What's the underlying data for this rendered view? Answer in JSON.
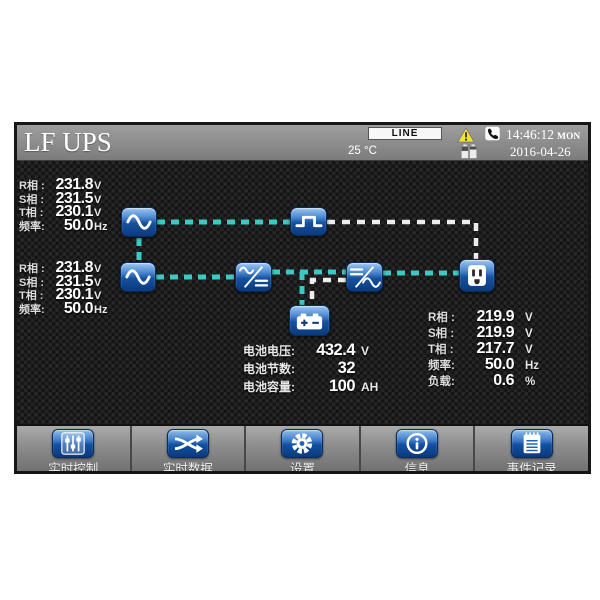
{
  "header": {
    "title": "LF UPS",
    "status": {
      "line": "LINE",
      "temperature": "25 °C",
      "time": "14:46:12",
      "weekday": "MON",
      "date": "2016-04-26",
      "icons": [
        "warning-icon",
        "battery-cells-icon",
        "phone-icon"
      ]
    }
  },
  "bypass_input": {
    "rows": [
      {
        "label": "R相 :",
        "value": "231.8",
        "unit": "V"
      },
      {
        "label": "S相 :",
        "value": "231.5",
        "unit": "V"
      },
      {
        "label": "T相 :",
        "value": "230.1",
        "unit": "V"
      },
      {
        "label": "频率:",
        "value": "50.0",
        "unit": "Hz"
      }
    ]
  },
  "main_input": {
    "rows": [
      {
        "label": "R相 :",
        "value": "231.8",
        "unit": "V"
      },
      {
        "label": "S相 :",
        "value": "231.5",
        "unit": "V"
      },
      {
        "label": "T相 :",
        "value": "230.1",
        "unit": "V"
      },
      {
        "label": "频率:",
        "value": "50.0",
        "unit": "Hz"
      }
    ]
  },
  "output": {
    "rows": [
      {
        "label": "R相 :",
        "value": "219.9",
        "unit": "V"
      },
      {
        "label": "S相 :",
        "value": "219.9",
        "unit": "V"
      },
      {
        "label": "T相 :",
        "value": "217.7",
        "unit": "V"
      },
      {
        "label": "频率:",
        "value": "50.0",
        "unit": "Hz"
      },
      {
        "label": "负载:",
        "value": "0.6",
        "unit": "%"
      }
    ]
  },
  "battery": {
    "rows": [
      {
        "label": "电池电压:",
        "value": "432.4",
        "unit": "V"
      },
      {
        "label": "电池节数:",
        "value": "32",
        "unit": ""
      },
      {
        "label": "电池容量:",
        "value": "100",
        "unit": "AH"
      }
    ]
  },
  "diagram": {
    "nodes": [
      "ac-source-bypass",
      "bypass-switch",
      "ac-source-main",
      "rectifier",
      "inverter",
      "battery",
      "output-socket"
    ],
    "flow_active_color": "#3cc9c3",
    "flow_standby_color": "#ededed"
  },
  "nav": {
    "items": [
      {
        "icon": "sliders-icon",
        "label": "实时控制"
      },
      {
        "icon": "shuffle-icon",
        "label": "实时数据"
      },
      {
        "icon": "gear-icon",
        "label": "设置"
      },
      {
        "icon": "info-icon",
        "label": "信息"
      },
      {
        "icon": "event-log-icon",
        "label": "事件记录"
      }
    ]
  },
  "colors": {
    "accent_blue": "#1d5fb2",
    "warning_yellow": "#f2e235",
    "header_gray": "#8c8c8c"
  }
}
